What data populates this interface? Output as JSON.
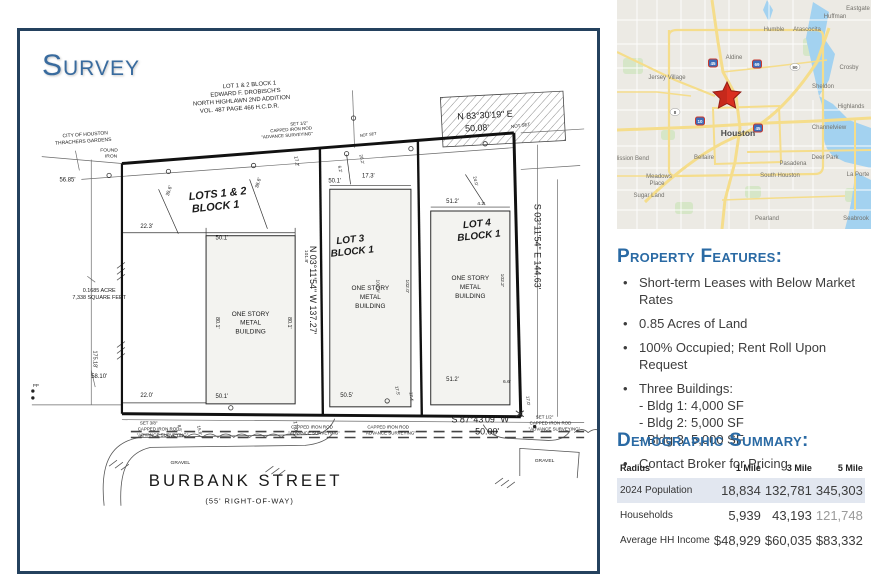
{
  "colors": {
    "accent_blue": "#2a6aa4",
    "frame_navy": "#24415e",
    "star_red": "#da2f20",
    "row_shade": "#e2e7f0",
    "map_water": "#a3d2f0",
    "map_road_yellow": "#f5dd8b"
  },
  "survey": {
    "title": "Survey",
    "annotations": [
      {
        "t": "LOT 1 & 2 BLOCK 1",
        "x": 232,
        "y": 56,
        "s": 6,
        "r": -4
      },
      {
        "t": "EDWARD F. DROBISCH'S",
        "x": 228,
        "y": 64,
        "s": 6,
        "r": -4
      },
      {
        "t": "NORTH HIGHLAWN 2ND ADDITION",
        "x": 224,
        "y": 72,
        "s": 6,
        "r": -4
      },
      {
        "t": "VOL. 487 PAGE 466 H.C.D.R.",
        "x": 222,
        "y": 80,
        "s": 6,
        "r": -4
      },
      {
        "t": "CITY OF HOUSTON",
        "x": 66,
        "y": 106,
        "s": 5,
        "r": -4
      },
      {
        "t": "THRACHERS GARDENS",
        "x": 64,
        "y": 113,
        "s": 5,
        "r": -4
      },
      {
        "t": "FOUND",
        "x": 90,
        "y": 122,
        "s": 5
      },
      {
        "t": "IRON",
        "x": 92,
        "y": 128,
        "s": 5
      },
      {
        "t": "56.85'",
        "x": 48,
        "y": 152,
        "s": 6
      },
      {
        "t": "SET 1/2\"",
        "x": 282,
        "y": 95,
        "s": 4.5,
        "r": -4
      },
      {
        "t": "CAPPED IRON ROD",
        "x": 274,
        "y": 101,
        "s": 4.5,
        "r": -4
      },
      {
        "t": "\"ADVANCE SURVEYING\"",
        "x": 270,
        "y": 107,
        "s": 4.5,
        "r": -4
      },
      {
        "t": "NOT SET",
        "x": 352,
        "y": 106,
        "s": 4,
        "r": -8
      },
      {
        "t": "N 83°30'19\" E",
        "x": 470,
        "y": 88,
        "s": 9,
        "r": -3
      },
      {
        "t": "50.08'",
        "x": 462,
        "y": 101,
        "s": 9,
        "r": -3
      },
      {
        "t": "NOT SET",
        "x": 506,
        "y": 97,
        "s": 4.5,
        "r": -8
      },
      {
        "t": "LOTS 1 & 2",
        "x": 200,
        "y": 168,
        "s": 11,
        "b": 1,
        "i": 1,
        "r": -6
      },
      {
        "t": "BLOCK 1",
        "x": 198,
        "y": 181,
        "s": 11,
        "b": 1,
        "i": 1,
        "r": -6
      },
      {
        "t": "LOT 3",
        "x": 334,
        "y": 214,
        "s": 10,
        "b": 1,
        "i": 1,
        "r": -6
      },
      {
        "t": "BLOCK 1",
        "x": 336,
        "y": 226,
        "s": 10,
        "b": 1,
        "i": 1,
        "r": -6
      },
      {
        "t": "LOT 4",
        "x": 462,
        "y": 198,
        "s": 10,
        "b": 1,
        "i": 1,
        "r": -6
      },
      {
        "t": "BLOCK 1",
        "x": 464,
        "y": 210,
        "s": 10,
        "b": 1,
        "i": 1,
        "r": -6
      },
      {
        "t": "35.6'",
        "x": 152,
        "y": 162,
        "s": 5,
        "r": -72
      },
      {
        "t": "38.6'",
        "x": 242,
        "y": 154,
        "s": 5,
        "r": -72
      },
      {
        "t": "17.2'",
        "x": 278,
        "y": 132,
        "s": 5,
        "r": 80
      },
      {
        "t": "22.3'",
        "x": 128,
        "y": 199,
        "s": 6
      },
      {
        "t": "50.1'",
        "x": 204,
        "y": 211,
        "s": 6
      },
      {
        "t": "6.2'",
        "x": 322,
        "y": 140,
        "s": 4.5,
        "r": 78
      },
      {
        "t": "20.2'",
        "x": 344,
        "y": 130,
        "s": 4.5,
        "r": 78
      },
      {
        "t": "17.3'",
        "x": 352,
        "y": 148,
        "s": 6
      },
      {
        "t": "50.1'",
        "x": 318,
        "y": 153,
        "s": 6
      },
      {
        "t": "24.0'",
        "x": 459,
        "y": 152,
        "s": 4.5,
        "r": 78
      },
      {
        "t": "4.2'",
        "x": 466,
        "y": 176,
        "s": 5
      },
      {
        "t": "51.2'",
        "x": 437,
        "y": 174,
        "s": 6
      },
      {
        "t": "N 03°11'54\" W  137.27'",
        "x": 293,
        "y": 262,
        "s": 9,
        "r": 90
      },
      {
        "t": "S 03°11'54\" E  144.63'",
        "x": 520,
        "y": 218,
        "s": 9,
        "r": 90
      },
      {
        "t": "101.8'",
        "x": 288,
        "y": 228,
        "s": 5,
        "r": 90
      },
      {
        "t": "80.1'",
        "x": 198,
        "y": 295,
        "s": 5.5,
        "r": 90
      },
      {
        "t": "80.1'",
        "x": 271,
        "y": 295,
        "s": 5.5,
        "r": 90
      },
      {
        "t": "102.4'",
        "x": 360,
        "y": 258,
        "s": 5,
        "r": 90
      },
      {
        "t": "102.0'",
        "x": 390,
        "y": 258,
        "s": 5,
        "r": 90
      },
      {
        "t": "102.2'",
        "x": 486,
        "y": 252,
        "s": 5,
        "r": 90
      },
      {
        "t": "175.18'",
        "x": 74,
        "y": 332,
        "s": 5.5,
        "r": 90
      },
      {
        "t": "0.1685 ACRE",
        "x": 80,
        "y": 264,
        "s": 5.5
      },
      {
        "t": "7,338 SQUARE FEET",
        "x": 80,
        "y": 271,
        "s": 5.5
      },
      {
        "t": "ONE STORY",
        "x": 233,
        "y": 288,
        "s": 6.5
      },
      {
        "t": "METAL",
        "x": 233,
        "y": 297,
        "s": 6.5
      },
      {
        "t": "BUILDING",
        "x": 233,
        "y": 306,
        "s": 6.5
      },
      {
        "t": "ONE STORY",
        "x": 354,
        "y": 262,
        "s": 6.5
      },
      {
        "t": "METAL",
        "x": 354,
        "y": 271,
        "s": 6.5
      },
      {
        "t": "BUILDING",
        "x": 354,
        "y": 280,
        "s": 6.5
      },
      {
        "t": "ONE STORY",
        "x": 455,
        "y": 252,
        "s": 6.5
      },
      {
        "t": "METAL",
        "x": 455,
        "y": 261,
        "s": 6.5
      },
      {
        "t": "BUILDING",
        "x": 455,
        "y": 270,
        "s": 6.5
      },
      {
        "t": "22.0'",
        "x": 128,
        "y": 370,
        "s": 6
      },
      {
        "t": "50.1'",
        "x": 204,
        "y": 371,
        "s": 6
      },
      {
        "t": "8.5'",
        "x": 160,
        "y": 402,
        "s": 4.5,
        "r": 78
      },
      {
        "t": "15.8'",
        "x": 180,
        "y": 404,
        "s": 4.5,
        "r": 78
      },
      {
        "t": "17.0'",
        "x": 277,
        "y": 400,
        "s": 5,
        "r": 84
      },
      {
        "t": "50.5'",
        "x": 330,
        "y": 370,
        "s": 6
      },
      {
        "t": "17.5'",
        "x": 380,
        "y": 364,
        "s": 4.5,
        "r": 78
      },
      {
        "t": "17.4'",
        "x": 394,
        "y": 370,
        "s": 4.5,
        "r": 84
      },
      {
        "t": "51.2'",
        "x": 437,
        "y": 354,
        "s": 6
      },
      {
        "t": "6.6'",
        "x": 492,
        "y": 356,
        "s": 5
      },
      {
        "t": "17.0'",
        "x": 512,
        "y": 374,
        "s": 4.5,
        "r": 84
      },
      {
        "t": "58.10'",
        "x": 80,
        "y": 351,
        "s": 6
      },
      {
        "t": "PP",
        "x": 16,
        "y": 360,
        "s": 4.5
      },
      {
        "t": "S 87°43'09\" W",
        "x": 465,
        "y": 396,
        "s": 9
      },
      {
        "t": "50.00'",
        "x": 472,
        "y": 408,
        "s": 9
      },
      {
        "t": "SET 3/8\"",
        "x": 130,
        "y": 398,
        "s": 4.5
      },
      {
        "t": "CAPPED IRON ROD",
        "x": 140,
        "y": 404,
        "s": 4.5
      },
      {
        "t": "\"ADVANCE SURVEYING\"",
        "x": 144,
        "y": 410,
        "s": 4.5
      },
      {
        "t": "CAPPED IRON ROD",
        "x": 295,
        "y": 402,
        "s": 4.5
      },
      {
        "t": "\"ADVANCE SURVEYING\"",
        "x": 297,
        "y": 408,
        "s": 4.5
      },
      {
        "t": "CAPPED IRON ROD",
        "x": 372,
        "y": 402,
        "s": 4.5
      },
      {
        "t": "\"ADVANCE SURVEYING\"",
        "x": 374,
        "y": 408,
        "s": 4.5
      },
      {
        "t": "SET 1/2\"",
        "x": 530,
        "y": 392,
        "s": 4.5
      },
      {
        "t": "CAPPED IRON ROD",
        "x": 536,
        "y": 398,
        "s": 4.5
      },
      {
        "t": "\"ADVANCE SURVEYING\"",
        "x": 540,
        "y": 404,
        "s": 4.5
      },
      {
        "t": "GRAVEL",
        "x": 162,
        "y": 438,
        "s": 5
      },
      {
        "t": "GRAVEL",
        "x": 530,
        "y": 436,
        "s": 5
      },
      {
        "t": "BURBANK STREET",
        "x": 228,
        "y": 460,
        "s": 17,
        "ls": 3
      },
      {
        "t": "(55' RIGHT-OF-WAY)",
        "x": 232,
        "y": 478,
        "s": 7.5,
        "ls": 1
      }
    ]
  },
  "map": {
    "marker": "red-star",
    "labels": [
      {
        "t": "Eastgate",
        "x": 241,
        "y": 10
      },
      {
        "t": "Huffman",
        "x": 218,
        "y": 18
      },
      {
        "t": "Humble",
        "x": 157,
        "y": 31
      },
      {
        "t": "Atascocita",
        "x": 190,
        "y": 31
      },
      {
        "t": "Aldine",
        "x": 117,
        "y": 59
      },
      {
        "t": "Jersey Village",
        "x": 50,
        "y": 79
      },
      {
        "t": "Crosby",
        "x": 232,
        "y": 69
      },
      {
        "t": "Sheldon",
        "x": 206,
        "y": 88
      },
      {
        "t": "Highlands",
        "x": 234,
        "y": 108
      },
      {
        "t": "Channelview",
        "x": 212,
        "y": 129
      },
      {
        "t": "Houston",
        "x": 121,
        "y": 136,
        "b": 1,
        "s": 8.5,
        "f": "#4a4a4a"
      },
      {
        "t": "Bellaire",
        "x": 87,
        "y": 159
      },
      {
        "t": "Pasadena",
        "x": 176,
        "y": 165
      },
      {
        "t": "Deer Park",
        "x": 208,
        "y": 159
      },
      {
        "t": "South Houston",
        "x": 163,
        "y": 177
      },
      {
        "t": "La Porte",
        "x": 241,
        "y": 176
      },
      {
        "t": "Meadows",
        "x": 42,
        "y": 178
      },
      {
        "t": "Place",
        "x": 40,
        "y": 185
      },
      {
        "t": "Sugar Land",
        "x": 32,
        "y": 197
      },
      {
        "t": "Mission Bend",
        "x": 14,
        "y": 160
      },
      {
        "t": "Pearland",
        "x": 150,
        "y": 220
      },
      {
        "t": "Seabrook",
        "x": 239,
        "y": 220
      }
    ],
    "shields": [
      {
        "t": "45",
        "x": 96,
        "y": 63
      },
      {
        "t": "69",
        "x": 140,
        "y": 64
      },
      {
        "t": "10",
        "x": 83,
        "y": 121
      },
      {
        "t": "45",
        "x": 141,
        "y": 128
      },
      {
        "t": "8",
        "x": 58,
        "y": 112,
        "oval": 1
      },
      {
        "t": "90",
        "x": 178,
        "y": 67,
        "oval": 1
      }
    ]
  },
  "features": {
    "heading": "Property Features:",
    "items": [
      {
        "text": "Short-term Leases with Below Market Rates"
      },
      {
        "text": "0.85 Acres of Land"
      },
      {
        "text": "100% Occupied; Rent Roll Upon Request"
      },
      {
        "text": "Three Buildings:",
        "subs": [
          "- Bldg 1: 4,000 SF",
          "- Bldg 2: 5,000 SF",
          "- Bldg 3: 5,000 SF"
        ]
      },
      {
        "text": "Contact Broker for Pricing"
      }
    ]
  },
  "demographics": {
    "heading": "Demographic Summary:",
    "columns": [
      "Radius",
      "1 Mile",
      "3 Mile",
      "5 Mile"
    ],
    "rows": [
      {
        "label": "2024 Population",
        "values": [
          "18,834",
          "132,781",
          "345,303"
        ],
        "shaded": true
      },
      {
        "label": "Households",
        "values": [
          "5,939",
          "43,193",
          "121,748"
        ],
        "muted_col": 2
      },
      {
        "label": "Average HH Income",
        "values": [
          "$48,929",
          "$60,035",
          "$83,332"
        ]
      }
    ]
  }
}
